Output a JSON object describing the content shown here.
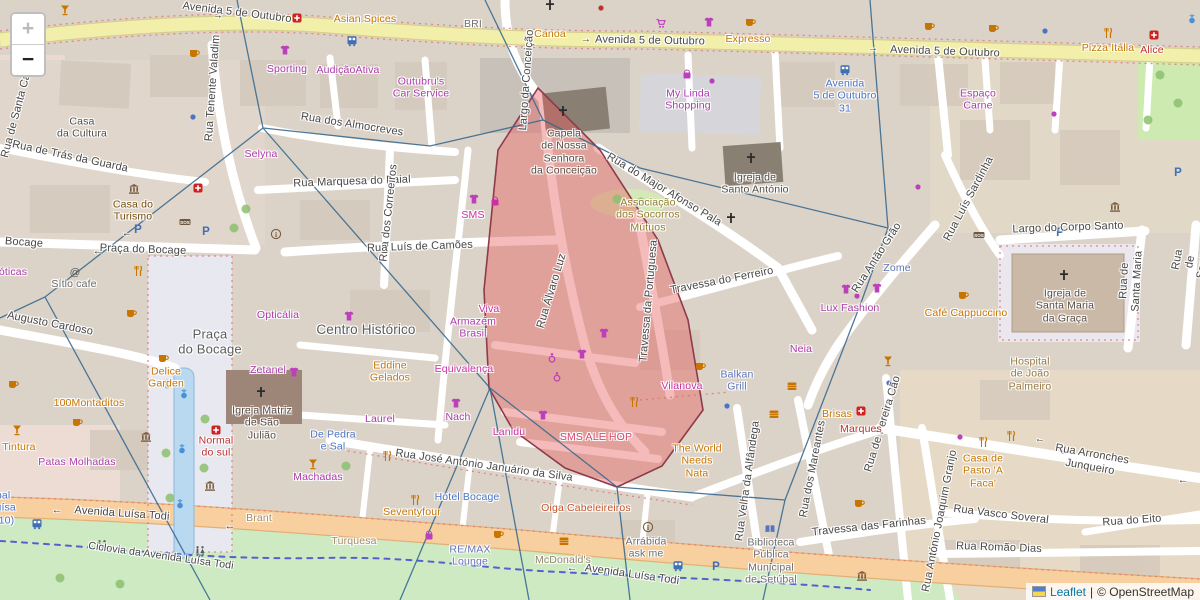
{
  "app": {
    "kind": "leaflet-openstreetmap-viewer"
  },
  "controls": {
    "zoom_in": "+",
    "zoom_out": "−"
  },
  "attribution": {
    "flag": "ukraine-flag",
    "leaflet": "Leaflet",
    "sep": "|",
    "copyright": "© OpenStreetMap"
  },
  "colors": {
    "highlight_fill": "#e85c5c",
    "highlight_stroke": "#8f3a4a",
    "voronoi_line": "#35688f",
    "road_primary": "#f8cf9e",
    "road_secondary": "#f2efab",
    "grass": "#cdeac2",
    "building": "#d9cfc4",
    "shop_label": "#ac39ac",
    "food_label": "#c77400",
    "street_label": "#474747"
  },
  "highlight": {
    "name": "selected-district-polygon",
    "opacity": 0.42
  },
  "labels": [
    {
      "k": "street",
      "t": "Avenida 5 de Outubro",
      "x": 237,
      "y": 13,
      "r": 7
    },
    {
      "k": "street",
      "t": "Avenida 5 de Outubro",
      "x": 650,
      "y": 41,
      "r": 1
    },
    {
      "k": "street",
      "t": "Avenida 5 de Outubro",
      "x": 945,
      "y": 52,
      "r": 2
    },
    {
      "k": "street",
      "t": "Rua Tenente Valadim",
      "x": 213,
      "y": 88,
      "r": -86
    },
    {
      "k": "street",
      "t": "Rua de Santa Catarina",
      "x": 20,
      "y": 102,
      "r": -75
    },
    {
      "k": "street",
      "t": "Rua de Trás da Guarda",
      "x": 70,
      "y": 157,
      "r": 12
    },
    {
      "k": "street",
      "t": "Rua dos Almocreves",
      "x": 352,
      "y": 125,
      "r": 9
    },
    {
      "k": "street",
      "t": "Rua Marquesa do Faial",
      "x": 352,
      "y": 182,
      "r": -2
    },
    {
      "k": "street",
      "t": "Rua dos Correeiros",
      "x": 389,
      "y": 213,
      "r": -84
    },
    {
      "k": "street",
      "t": "Rua Luís de Camões",
      "x": 420,
      "y": 247,
      "r": -2
    },
    {
      "k": "street",
      "t": "Praça do Bocage",
      "x": 143,
      "y": 250,
      "r": 2
    },
    {
      "k": "street",
      "t": "Bocage",
      "x": 24,
      "y": 243,
      "r": 4
    },
    {
      "k": "street",
      "t": "Augusto Cardoso",
      "x": 50,
      "y": 324,
      "r": 11
    },
    {
      "k": "street",
      "t": "Largo da Conceição",
      "x": 527,
      "y": 80,
      "r": -86
    },
    {
      "k": "street",
      "t": "Rua do Major Afonso Pala",
      "x": 664,
      "y": 190,
      "r": 31
    },
    {
      "k": "street",
      "t": "Travessa do Ferreiro",
      "x": 722,
      "y": 281,
      "r": -11
    },
    {
      "k": "street",
      "t": "Rua Antão Grão",
      "x": 877,
      "y": 258,
      "r": -57
    },
    {
      "k": "street",
      "t": "Largo do Corpo Santo",
      "x": 1068,
      "y": 228,
      "r": -2
    },
    {
      "k": "street",
      "t": "Rua Luís Sardinha",
      "x": 969,
      "y": 199,
      "r": -62
    },
    {
      "k": "street",
      "t": "Rua de Santa Maria",
      "x": 1131,
      "y": 281,
      "r": -87
    },
    {
      "k": "street",
      "t": "Rua de Santa Maria",
      "x": 1197,
      "y": 263,
      "r": -80
    },
    {
      "k": "street",
      "t": "Rua José António Januário da Silva",
      "x": 484,
      "y": 466,
      "r": 8
    },
    {
      "k": "street",
      "t": "Avenida Luísa Todi",
      "x": 122,
      "y": 514,
      "r": 4
    },
    {
      "k": "street",
      "t": "Avenida Luísa Todi",
      "x": 632,
      "y": 575,
      "r": 8
    },
    {
      "k": "street",
      "t": "Ciclovia da Avenida Luísa Todi",
      "x": 161,
      "y": 556,
      "r": 8,
      "s": 10.5
    },
    {
      "k": "street",
      "t": "Rua Arronches Junqueiro",
      "x": 1091,
      "y": 461,
      "r": 10
    },
    {
      "k": "street",
      "t": "Rua Vasco Soveral",
      "x": 1001,
      "y": 515,
      "r": 7
    },
    {
      "k": "street",
      "t": "Rua do Eito",
      "x": 1132,
      "y": 521,
      "r": -4
    },
    {
      "k": "street",
      "t": "Rua Romão Dias",
      "x": 999,
      "y": 548,
      "r": 2
    },
    {
      "k": "street",
      "t": "Rua António Joaquim Granjo",
      "x": 940,
      "y": 521,
      "r": -79
    },
    {
      "k": "street",
      "t": "Travessa das Farinhas",
      "x": 869,
      "y": 527,
      "r": -6
    },
    {
      "k": "street",
      "t": "Rua dos Mareantes",
      "x": 813,
      "y": 469,
      "r": -79
    },
    {
      "k": "street",
      "t": "Rua de Pereira Cão",
      "x": 883,
      "y": 424,
      "r": -73
    },
    {
      "k": "street",
      "t": "Rua Velha da Alfândega",
      "x": 748,
      "y": 481,
      "r": -82
    },
    {
      "k": "street",
      "t": "Travessa da Portuguesa",
      "x": 649,
      "y": 301,
      "r": -85
    },
    {
      "k": "street",
      "t": "Rua Álvaro Luz",
      "x": 552,
      "y": 291,
      "r": -73
    },
    {
      "k": "place",
      "t": "Praça\ndo Bocage",
      "x": 210,
      "y": 342,
      "s": 13,
      "c": "#5b5b5b"
    },
    {
      "k": "place",
      "t": "Centro Histórico",
      "x": 366,
      "y": 330,
      "s": 13.5,
      "c": "#5b5b5b"
    },
    {
      "k": "poi",
      "t": "Selyna",
      "x": 261,
      "y": 154,
      "c": "#ac39ac"
    },
    {
      "k": "poi",
      "t": "óticas",
      "x": 13,
      "y": 272,
      "c": "#ac39ac"
    },
    {
      "k": "poi",
      "t": "AudiçãoAtiva",
      "x": 348,
      "y": 70,
      "c": "#ac39ac"
    },
    {
      "k": "poi",
      "t": "Sporting",
      "x": 287,
      "y": 69,
      "c": "#ac39ac"
    },
    {
      "k": "poi",
      "t": "Outubru's\nCar Service",
      "x": 421,
      "y": 88,
      "c": "#ac39ac"
    },
    {
      "k": "poi",
      "t": "My Linda\nShopping",
      "x": 688,
      "y": 100,
      "c": "#ac39ac"
    },
    {
      "k": "poi",
      "t": "Espaço\nCarne",
      "x": 978,
      "y": 100,
      "c": "#ac39ac"
    },
    {
      "k": "poi",
      "t": "Armazém\nBrasil",
      "x": 473,
      "y": 328,
      "c": "#ac39ac"
    },
    {
      "k": "poi",
      "t": "Laurel",
      "x": 380,
      "y": 419,
      "c": "#ac39ac"
    },
    {
      "k": "poi",
      "t": "Nach",
      "x": 458,
      "y": 417,
      "c": "#ac39ac"
    },
    {
      "k": "poi",
      "t": "Machadas",
      "x": 318,
      "y": 477,
      "c": "#ac39ac"
    },
    {
      "k": "poi",
      "t": "Patas Molhadas",
      "x": 77,
      "y": 462,
      "c": "#ac39ac"
    },
    {
      "k": "poi",
      "t": "Zetanel",
      "x": 268,
      "y": 370,
      "c": "#ac39ac"
    },
    {
      "k": "poi",
      "t": "Opticália",
      "x": 278,
      "y": 315,
      "c": "#ac39ac"
    },
    {
      "k": "poi",
      "t": "Lux Fashion",
      "x": 850,
      "y": 308,
      "c": "#ac39ac"
    },
    {
      "k": "poi",
      "t": "Neia",
      "x": 801,
      "y": 349,
      "c": "#ac39ac"
    },
    {
      "k": "poi",
      "t": "Oiga Cabeleireiros",
      "x": 586,
      "y": 508,
      "c": "#c7542a"
    },
    {
      "k": "poi",
      "t": "SMS",
      "x": 473,
      "y": 215,
      "c": "#cc2fa6"
    },
    {
      "k": "poi",
      "t": "Viva",
      "x": 489,
      "y": 309,
      "c": "#cc2fa6"
    },
    {
      "k": "poi",
      "t": "Equivalença",
      "x": 464,
      "y": 369,
      "c": "#cc2fa6"
    },
    {
      "k": "poi",
      "t": "Lanidu",
      "x": 509,
      "y": 432,
      "c": "#cc2fa6"
    },
    {
      "k": "poi",
      "t": "SMS ALE HOP",
      "x": 596,
      "y": 437,
      "c": "#d64570"
    },
    {
      "k": "poi",
      "t": "Vilanova",
      "x": 682,
      "y": 386,
      "c": "#cc2fa6"
    },
    {
      "k": "poi",
      "t": "Asian Spices",
      "x": 365,
      "y": 19,
      "c": "#c77400"
    },
    {
      "k": "poi",
      "t": "Canoa",
      "x": 550,
      "y": 34,
      "c": "#c77400"
    },
    {
      "k": "poi",
      "t": "Expresso",
      "x": 748,
      "y": 39,
      "c": "#c77400"
    },
    {
      "k": "poi",
      "t": "Pizza Itália",
      "x": 1108,
      "y": 48,
      "c": "#c77400"
    },
    {
      "k": "poi",
      "t": "Eddine\nGelados",
      "x": 390,
      "y": 372,
      "c": "#c77400"
    },
    {
      "k": "poi",
      "t": "100Montaditos",
      "x": 89,
      "y": 403,
      "c": "#c77400"
    },
    {
      "k": "poi",
      "t": "Delice\nGarden",
      "x": 166,
      "y": 378,
      "c": "#c77400"
    },
    {
      "k": "poi",
      "t": "Tintura",
      "x": 19,
      "y": 447,
      "c": "#c77400"
    },
    {
      "k": "poi",
      "t": "Seventyfour",
      "x": 412,
      "y": 512,
      "c": "#c77400"
    },
    {
      "k": "poi",
      "t": "The World\nNeeds\nNata",
      "x": 697,
      "y": 461,
      "c": "#c77400"
    },
    {
      "k": "poi",
      "t": "Casa de\nPasto 'A\nFaca'",
      "x": 983,
      "y": 471,
      "c": "#c77400"
    },
    {
      "k": "poi",
      "t": "Café Cappuccino",
      "x": 966,
      "y": 313,
      "c": "#c77400"
    },
    {
      "k": "poi",
      "t": "Brisas",
      "x": 837,
      "y": 414,
      "c": "#c77400"
    },
    {
      "k": "poi",
      "t": "Alice",
      "x": 1152,
      "y": 50,
      "c": "#c03030"
    },
    {
      "k": "poi",
      "t": "Normal\ndo sul",
      "x": 216,
      "y": 447,
      "c": "#c03030"
    },
    {
      "k": "poi",
      "t": "Marques",
      "x": 861,
      "y": 429,
      "c": "#c03030"
    },
    {
      "k": "poi",
      "t": "Avenida\n5 de Outubro\n31",
      "x": 845,
      "y": 96,
      "c": "#4a74c4"
    },
    {
      "k": "poi",
      "t": "De Pedra\ne Sal",
      "x": 333,
      "y": 441,
      "c": "#4a74c4"
    },
    {
      "k": "poi",
      "t": "Hotel Bocage",
      "x": 467,
      "y": 497,
      "c": "#4a74c4"
    },
    {
      "k": "poi",
      "t": "Setúbal\n(Av. Luísa\nTodi 310)",
      "x": -8,
      "y": 508,
      "c": "#4a74c4"
    },
    {
      "k": "poi",
      "t": "Zome",
      "x": 897,
      "y": 268,
      "c": "#5a74b8"
    },
    {
      "k": "poi",
      "t": "Balkan\nGrill",
      "x": 737,
      "y": 381,
      "c": "#5a74b8"
    },
    {
      "k": "poi",
      "t": "RE/MAX\nLounge",
      "x": 470,
      "y": 556,
      "c": "#6a74b8"
    },
    {
      "k": "poi",
      "t": "Casa do\nTurismo",
      "x": 133,
      "y": 211,
      "c": "#734a08"
    },
    {
      "k": "poi",
      "t": "Sítio cafe",
      "x": 74,
      "y": 284,
      "c": "#6a6a6a"
    },
    {
      "k": "poi",
      "t": "Capela\nde Nossa\nSenhora\nda Conceição",
      "x": 564,
      "y": 152,
      "c": "#574c42"
    },
    {
      "k": "poi",
      "t": "Igreja de\nSanto António",
      "x": 755,
      "y": 184,
      "c": "#574c42"
    },
    {
      "k": "poi",
      "t": "Igreja de\nSanta Maria\nda Graça",
      "x": 1065,
      "y": 306,
      "c": "#574c42"
    },
    {
      "k": "poi",
      "t": "Igreja Matriz\nde São\nJulião",
      "x": 262,
      "y": 423,
      "c": "#574c42"
    },
    {
      "k": "poi",
      "t": "Casa\nda Cultura",
      "x": 82,
      "y": 128,
      "c": "#4e4e4e"
    },
    {
      "k": "poi",
      "t": "BRI",
      "x": 473,
      "y": 24,
      "c": "#707070"
    },
    {
      "k": "poi",
      "t": "Associação\ndos Socorros\nMútuos",
      "x": 648,
      "y": 215,
      "c": "#927c28"
    },
    {
      "k": "poi",
      "t": "Hospital\nde João\nPalmeiro",
      "x": 1030,
      "y": 374,
      "c": "#967840"
    },
    {
      "k": "poi",
      "t": "Arrábida\nask me",
      "x": 646,
      "y": 548,
      "c": "#6e6e6e"
    },
    {
      "k": "poi",
      "t": "Biblioteca\nPública\nMunicipal\nde Setúbal",
      "x": 771,
      "y": 561,
      "c": "#6e6e6e"
    },
    {
      "k": "poi",
      "t": "McDonald's",
      "x": 563,
      "y": 560,
      "c": "#94826a"
    },
    {
      "k": "poi",
      "t": "Turquesa",
      "x": 354,
      "y": 541,
      "c": "#a98a63"
    },
    {
      "k": "poi",
      "t": "Brant",
      "x": 259,
      "y": 518,
      "c": "#a98a63"
    },
    {
      "k": "arrow",
      "t": "←",
      "x": 98,
      "y": 252
    },
    {
      "k": "arrow",
      "t": "←",
      "x": 127,
      "y": 234
    },
    {
      "k": "arrow",
      "t": "→",
      "x": 218,
      "y": 16,
      "r": 7
    },
    {
      "k": "arrow",
      "t": "→",
      "x": 586,
      "y": 40
    },
    {
      "k": "arrow",
      "t": "→",
      "x": 873,
      "y": 49
    },
    {
      "k": "arrow",
      "t": "←",
      "x": 57,
      "y": 511
    },
    {
      "k": "arrow",
      "t": "←",
      "x": 572,
      "y": 569
    },
    {
      "k": "arrow",
      "t": "←",
      "x": 230,
      "y": 527
    },
    {
      "k": "arrow",
      "t": "←",
      "x": 1040,
      "y": 440,
      "r": 10
    },
    {
      "k": "arrow",
      "t": "←",
      "x": 1183,
      "y": 481
    }
  ],
  "icons": [
    {
      "t": "cross",
      "x": 550,
      "y": 5
    },
    {
      "t": "cross",
      "x": 563,
      "y": 111
    },
    {
      "t": "cross",
      "x": 751,
      "y": 158
    },
    {
      "t": "cross",
      "x": 731,
      "y": 218
    },
    {
      "t": "cross",
      "x": 261,
      "y": 392
    },
    {
      "t": "cross",
      "x": 1064,
      "y": 275
    },
    {
      "t": "parking",
      "x": 138,
      "y": 229
    },
    {
      "t": "parking",
      "x": 206,
      "y": 231
    },
    {
      "t": "parking",
      "x": 1060,
      "y": 232
    },
    {
      "t": "parking",
      "x": 1178,
      "y": 172
    },
    {
      "t": "parking",
      "x": 716,
      "y": 566
    },
    {
      "t": "bus",
      "x": 352,
      "y": 41
    },
    {
      "t": "bus",
      "x": 845,
      "y": 70
    },
    {
      "t": "bus",
      "x": 678,
      "y": 566
    },
    {
      "t": "bus",
      "x": 37,
      "y": 524
    },
    {
      "t": "cup",
      "x": 194,
      "y": 53
    },
    {
      "t": "cup",
      "x": 750,
      "y": 22
    },
    {
      "t": "cup",
      "x": 929,
      "y": 26
    },
    {
      "t": "cup",
      "x": 993,
      "y": 28
    },
    {
      "t": "cup",
      "x": 131,
      "y": 313
    },
    {
      "t": "cup",
      "x": 163,
      "y": 358
    },
    {
      "t": "cup",
      "x": 859,
      "y": 503
    },
    {
      "t": "cup",
      "x": 498,
      "y": 534
    },
    {
      "t": "cup",
      "x": 13,
      "y": 384
    },
    {
      "t": "cup",
      "x": 700,
      "y": 366
    },
    {
      "t": "cup",
      "x": 963,
      "y": 295
    },
    {
      "t": "cup",
      "x": 77,
      "y": 422
    },
    {
      "t": "fork",
      "x": 1108,
      "y": 33
    },
    {
      "t": "fork",
      "x": 387,
      "y": 456
    },
    {
      "t": "fork",
      "x": 138,
      "y": 271
    },
    {
      "t": "fork",
      "x": 634,
      "y": 402
    },
    {
      "t": "fork",
      "x": 983,
      "y": 442
    },
    {
      "t": "fork",
      "x": 1011,
      "y": 436
    },
    {
      "t": "fork",
      "x": 415,
      "y": 500
    },
    {
      "t": "glass",
      "x": 65,
      "y": 10
    },
    {
      "t": "glass",
      "x": 17,
      "y": 430
    },
    {
      "t": "glass",
      "x": 888,
      "y": 361
    },
    {
      "t": "glass",
      "x": 313,
      "y": 464
    },
    {
      "t": "shirt",
      "x": 285,
      "y": 50
    },
    {
      "t": "shirt",
      "x": 349,
      "y": 316
    },
    {
      "t": "shirt",
      "x": 294,
      "y": 372
    },
    {
      "t": "shirt",
      "x": 474,
      "y": 199
    },
    {
      "t": "shirt",
      "x": 582,
      "y": 354
    },
    {
      "t": "shirt",
      "x": 543,
      "y": 415
    },
    {
      "t": "shirt",
      "x": 456,
      "y": 403
    },
    {
      "t": "shirt",
      "x": 846,
      "y": 289
    },
    {
      "t": "shirt",
      "x": 877,
      "y": 288
    },
    {
      "t": "shirt",
      "x": 604,
      "y": 333
    },
    {
      "t": "shirt",
      "x": 709,
      "y": 22
    },
    {
      "t": "bag",
      "x": 687,
      "y": 74
    },
    {
      "t": "bag",
      "x": 429,
      "y": 535
    },
    {
      "t": "bag",
      "x": 495,
      "y": 201,
      "c": "#cc2fa6"
    },
    {
      "t": "cart",
      "x": 661,
      "y": 23
    },
    {
      "t": "pharmacy",
      "x": 198,
      "y": 188
    },
    {
      "t": "pharmacy",
      "x": 861,
      "y": 411
    },
    {
      "t": "pharmacy",
      "x": 216,
      "y": 430
    },
    {
      "t": "pharmacy",
      "x": 1154,
      "y": 35
    },
    {
      "t": "pharmacy",
      "x": 297,
      "y": 18
    },
    {
      "t": "sos",
      "x": 185,
      "y": 222
    },
    {
      "t": "sos",
      "x": 979,
      "y": 235
    },
    {
      "t": "bank",
      "x": 134,
      "y": 189
    },
    {
      "t": "bank",
      "x": 1115,
      "y": 207
    },
    {
      "t": "bank",
      "x": 862,
      "y": 576
    },
    {
      "t": "bank",
      "x": 146,
      "y": 437
    },
    {
      "t": "bank",
      "x": 210,
      "y": 486
    },
    {
      "t": "info",
      "x": 276,
      "y": 234
    },
    {
      "t": "info",
      "x": 648,
      "y": 527
    },
    {
      "t": "book",
      "x": 770,
      "y": 529
    },
    {
      "t": "burger",
      "x": 564,
      "y": 541
    },
    {
      "t": "burger",
      "x": 792,
      "y": 386
    },
    {
      "t": "burger",
      "x": 774,
      "y": 414
    },
    {
      "t": "fountain",
      "x": 1192,
      "y": 18
    },
    {
      "t": "fountain",
      "x": 184,
      "y": 393
    },
    {
      "t": "fountain",
      "x": 182,
      "y": 448
    },
    {
      "t": "fountain",
      "x": 180,
      "y": 503
    },
    {
      "t": "wc",
      "x": 102,
      "y": 545
    },
    {
      "t": "wc",
      "x": 200,
      "y": 551
    },
    {
      "t": "ring",
      "x": 552,
      "y": 358
    },
    {
      "t": "ring",
      "x": 557,
      "y": 377
    },
    {
      "t": "at",
      "x": 75,
      "y": 272
    },
    {
      "t": "tree",
      "x": 617,
      "y": 199
    },
    {
      "t": "tree",
      "x": 641,
      "y": 202
    },
    {
      "t": "tree",
      "x": 1160,
      "y": 75
    },
    {
      "t": "tree",
      "x": 1178,
      "y": 103
    },
    {
      "t": "tree",
      "x": 1148,
      "y": 120
    },
    {
      "t": "tree",
      "x": 167,
      "y": 384
    },
    {
      "t": "tree",
      "x": 205,
      "y": 419
    },
    {
      "t": "tree",
      "x": 166,
      "y": 453
    },
    {
      "t": "tree",
      "x": 204,
      "y": 468
    },
    {
      "t": "tree",
      "x": 170,
      "y": 498
    },
    {
      "t": "tree",
      "x": 346,
      "y": 466
    },
    {
      "t": "tree",
      "x": 246,
      "y": 209
    },
    {
      "t": "tree",
      "x": 234,
      "y": 228
    },
    {
      "t": "tree",
      "x": 60,
      "y": 578
    },
    {
      "t": "tree",
      "x": 120,
      "y": 584
    },
    {
      "t": "dot",
      "x": 1045,
      "y": 31,
      "c": "#4a74c4"
    },
    {
      "t": "dot",
      "x": 727,
      "y": 406,
      "c": "#4a74c4"
    },
    {
      "t": "dot",
      "x": 889,
      "y": 383,
      "c": "#4a74c4"
    },
    {
      "t": "dot",
      "x": 193,
      "y": 117,
      "c": "#4a74c4"
    },
    {
      "t": "dot",
      "x": 918,
      "y": 187,
      "c": "#bc3fbc"
    },
    {
      "t": "dot",
      "x": 960,
      "y": 437,
      "c": "#bc3fbc"
    },
    {
      "t": "dot",
      "x": 1063,
      "y": 451,
      "c": "#bc3fbc"
    },
    {
      "t": "dot",
      "x": 857,
      "y": 296,
      "c": "#bc3fbc"
    },
    {
      "t": "dot",
      "x": 712,
      "y": 81,
      "c": "#bc3fbc"
    },
    {
      "t": "dot",
      "x": 1054,
      "y": 114,
      "c": "#bc3fbc"
    },
    {
      "t": "dot",
      "x": 601,
      "y": 8,
      "c": "#c03030"
    }
  ]
}
